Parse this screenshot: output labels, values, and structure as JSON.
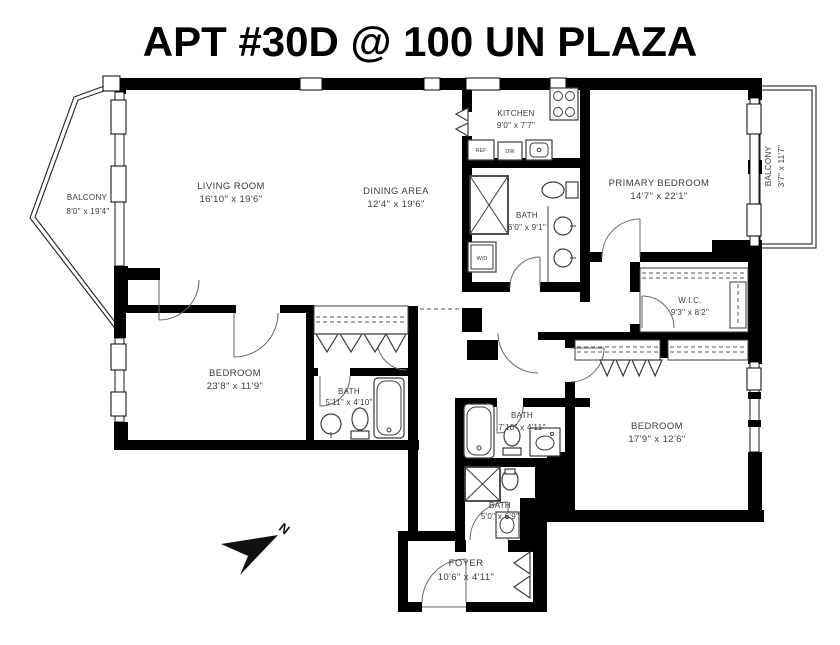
{
  "title": "APT #30D @ 100 UN PLAZA",
  "rooms": {
    "living_room": {
      "name": "LIVING ROOM",
      "dims": "16'10\" x 19'6\""
    },
    "dining_area": {
      "name": "DINING AREA",
      "dims": "12'4\" x 19'6\""
    },
    "kitchen": {
      "name": "KITCHEN",
      "dims": "9'0\" x 7'7\""
    },
    "primary_bedroom": {
      "name": "PRIMARY BEDROOM",
      "dims": "14'7\" x 22'1\""
    },
    "primary_bath": {
      "name": "BATH",
      "dims": "6'0\" x 9'1\""
    },
    "wic": {
      "name": "W.I.C.",
      "dims": "9'3\" x 8'2\""
    },
    "bedroom_left": {
      "name": "BEDROOM",
      "dims": "23'8\" x 11'9\""
    },
    "bath_left": {
      "name": "BATH",
      "dims": "5'11\" x 4'10\""
    },
    "bath_center": {
      "name": "BATH",
      "dims": "7'10\" x 4'11\""
    },
    "bath_lower": {
      "name": "BATH",
      "dims": "5'0\" x 6'9\""
    },
    "bedroom_right": {
      "name": "BEDROOM",
      "dims": "17'9\" x 12'6\""
    },
    "foyer": {
      "name": "FOYER",
      "dims": "10'6\" x 4'11\""
    },
    "balcony_left": {
      "name": "BALCONY",
      "dims": "8'0\" x 19'4\""
    },
    "balcony_right": {
      "name": "BALCONY",
      "dims": "3'7\" x 11'7\""
    }
  },
  "appliances": {
    "refrigerator": "REF",
    "dishwasher": "DW",
    "washer_dryer": "W/D"
  },
  "compass": {
    "north": "N"
  },
  "colors": {
    "walls": "#000000",
    "text": "#3a3a3a",
    "background": "#ffffff"
  }
}
